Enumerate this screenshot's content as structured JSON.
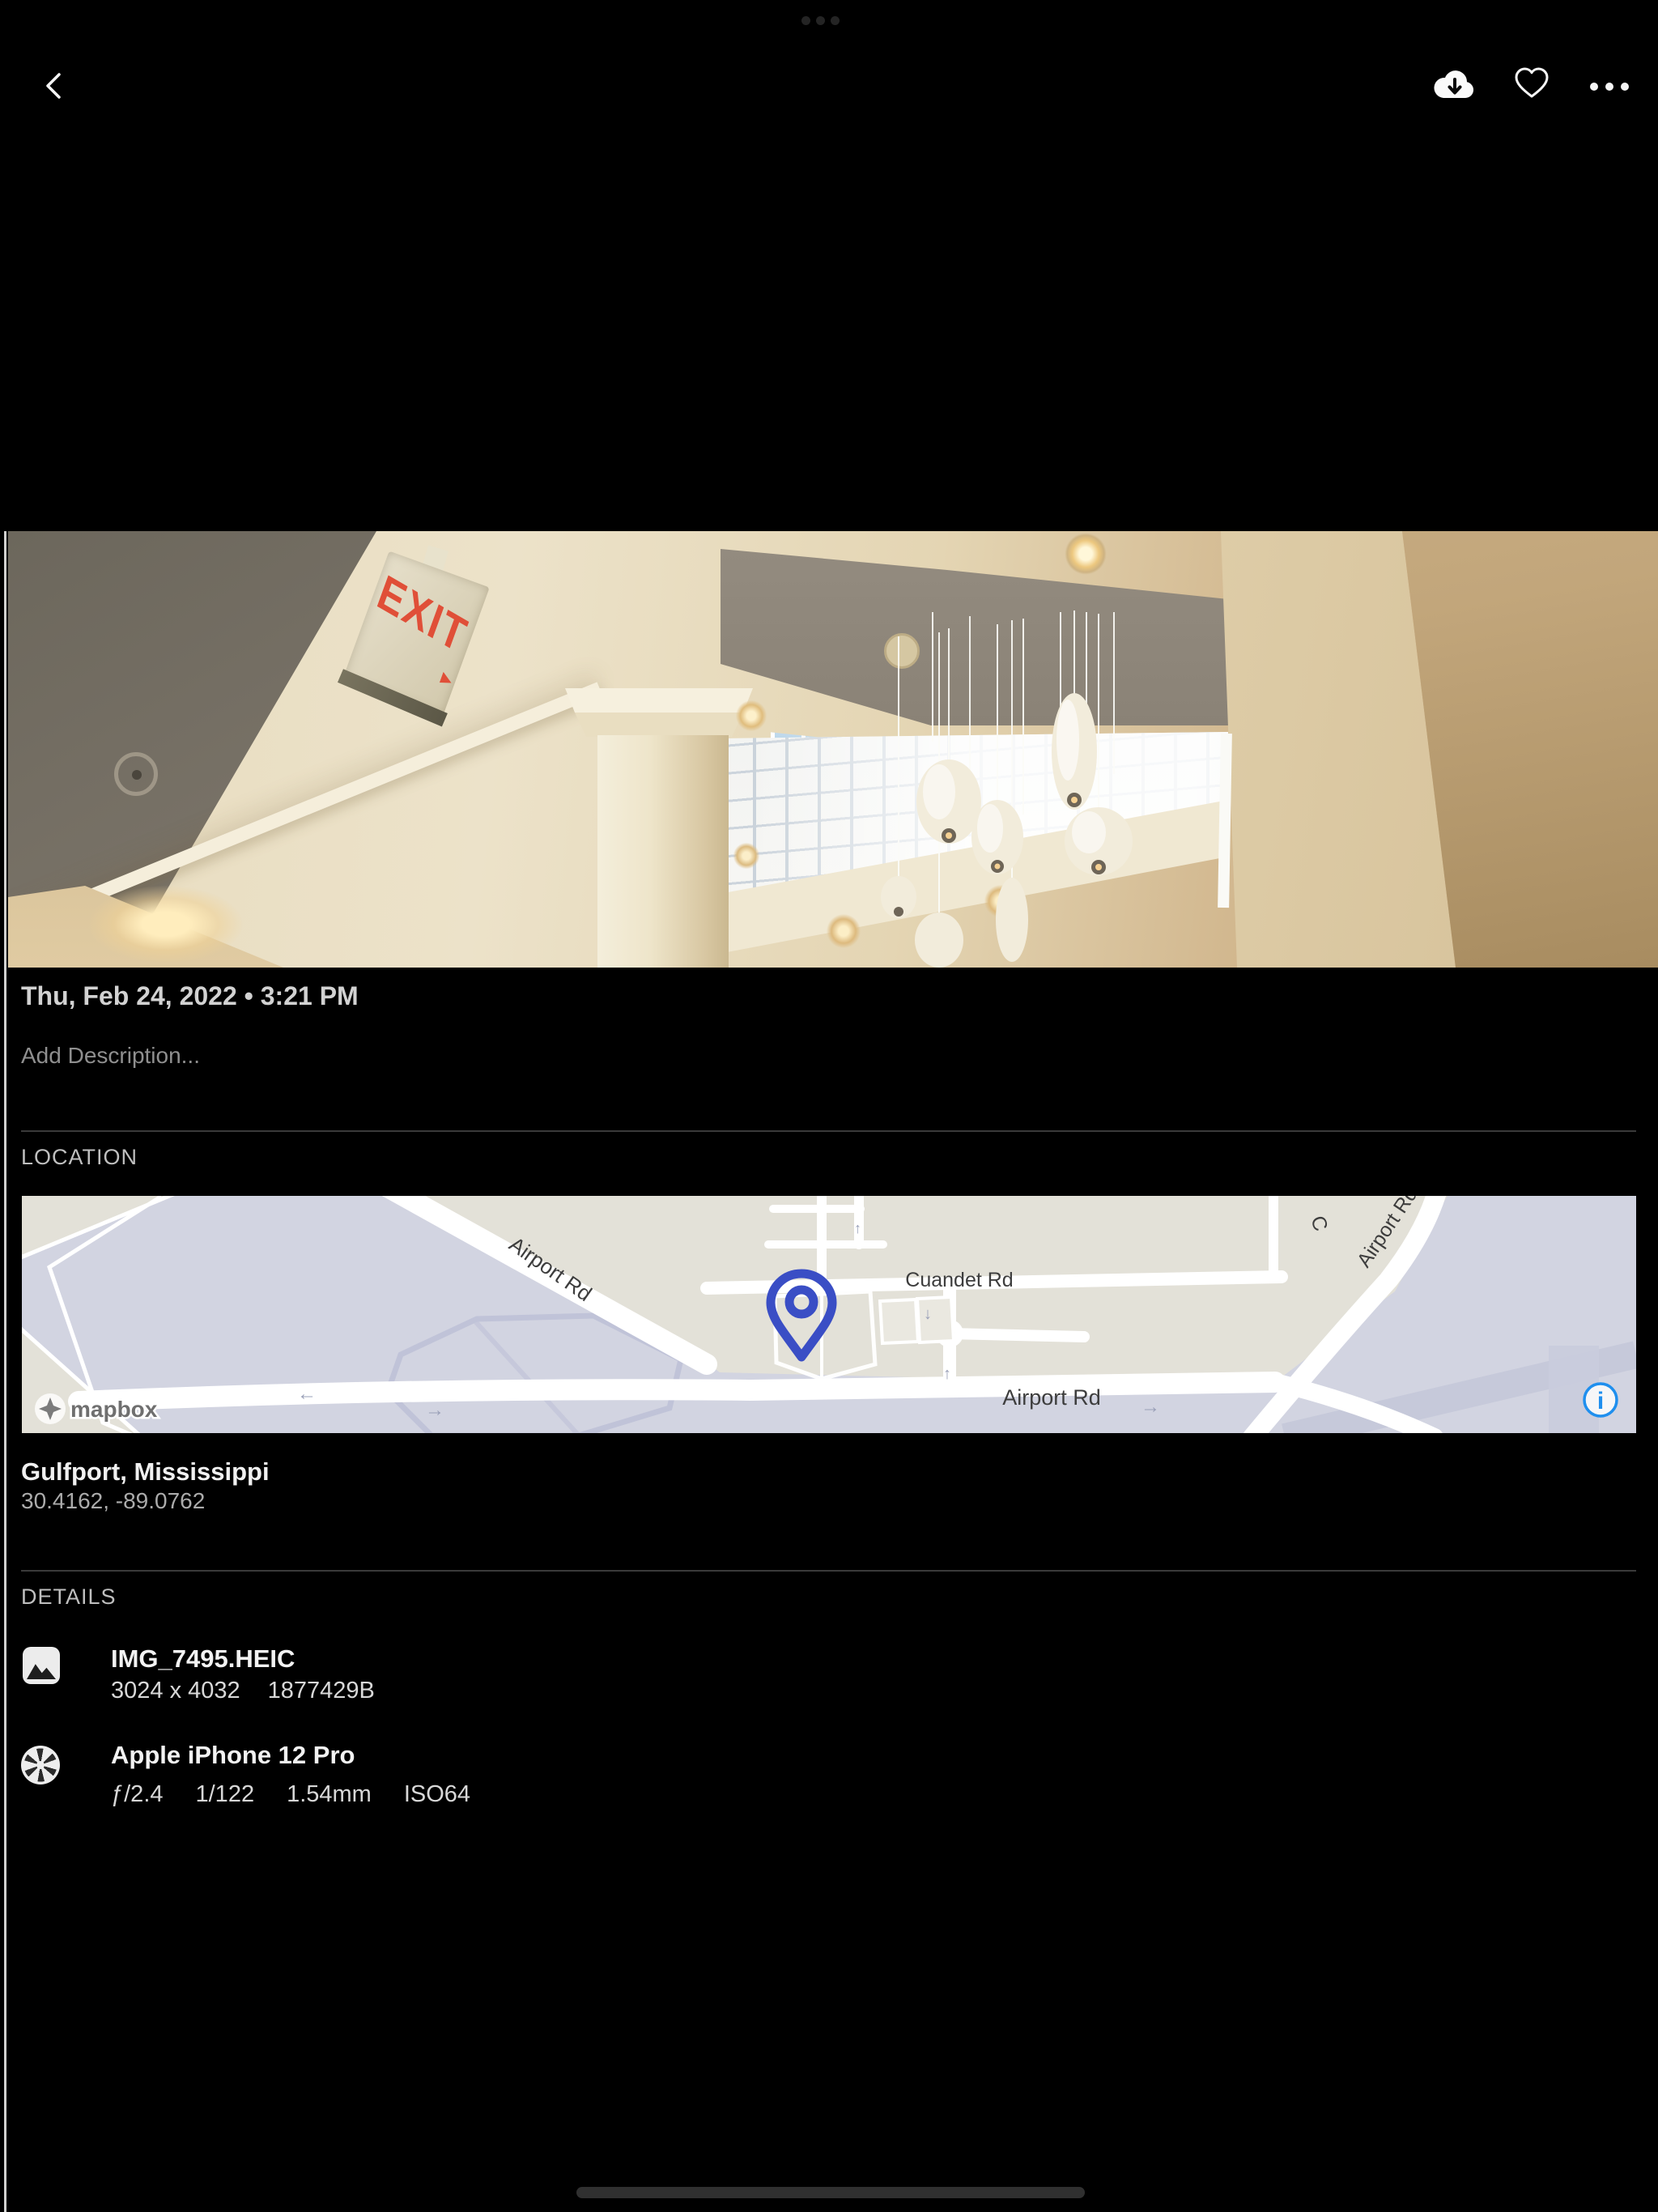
{
  "status_bar": {
    "multitask_indicator_icon": "ellipsis-dots"
  },
  "toolbar": {
    "back_icon": "chevron-left",
    "download_icon": "cloud-download",
    "favorite_icon": "heart-outline",
    "more_icon": "ellipsis-horizontal"
  },
  "photo": {
    "exit_sign_text": "EXIT",
    "exit_arrow": "▸"
  },
  "info": {
    "datetime": "Thu, Feb 24, 2022 • 3:21 PM",
    "description_placeholder": "Add Description...",
    "location": {
      "label": "LOCATION",
      "place": "Gulfport, Mississippi",
      "coordinates": "30.4162, -89.0762"
    },
    "map": {
      "attribution": "mapbox",
      "info_glyph": "i",
      "labels": {
        "road_nw": "Airport Rd",
        "road_cuandet": "Cuandet Rd",
        "road_main": "Airport Rd",
        "road_curve": "Airport Rd",
        "road_c_partial": "C"
      },
      "arrows": {
        "left": "←",
        "right": "→",
        "up": "↑",
        "down": "↓"
      },
      "colors": {
        "pin": "#3a4ec5",
        "info_icon": "#1f8fee",
        "land": "#e3e1d8",
        "water": "#d2d4e1",
        "road": "#ffffff"
      }
    },
    "details": {
      "label": "DETAILS",
      "file": {
        "icon": "image",
        "name": "IMG_7495.HEIC",
        "dimensions": "3024 x 4032",
        "size": "1877429B"
      },
      "camera": {
        "icon": "aperture",
        "name": "Apple iPhone 12 Pro",
        "aperture": "ƒ/2.4",
        "shutter": "1/122",
        "focal": "1.54mm",
        "iso": "ISO64"
      }
    }
  }
}
